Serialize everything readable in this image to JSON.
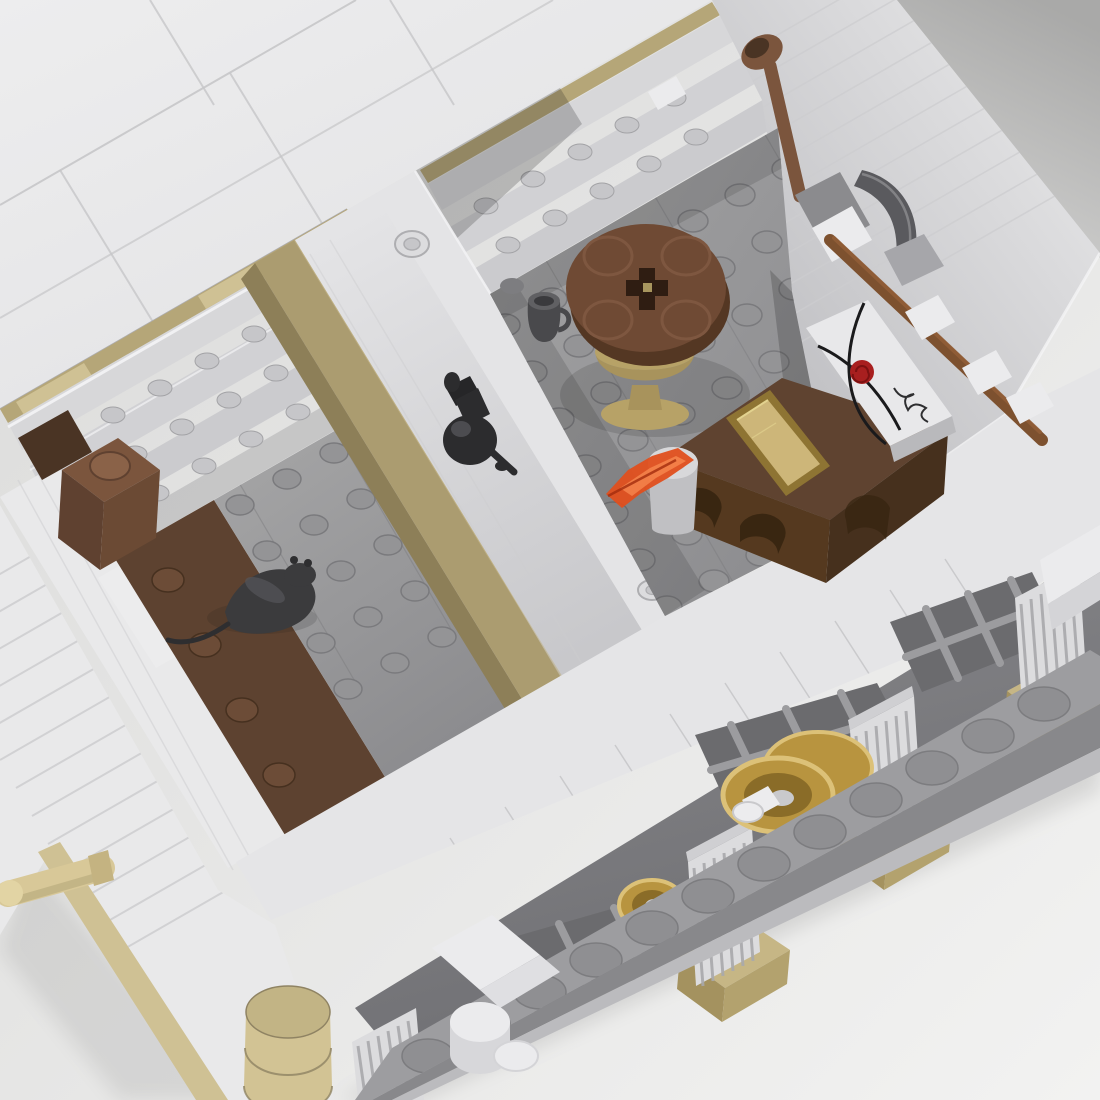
{
  "scene": {
    "description_objects": [
      {
        "id": "roof",
        "label": "white roof tiles"
      },
      {
        "id": "shelves",
        "label": "interior storage shelves with studs"
      },
      {
        "id": "barrel",
        "label": "brown round barrel brick"
      },
      {
        "id": "rat",
        "label": "black rat figure on floor"
      },
      {
        "id": "bench",
        "label": "tan bench along divider wall"
      },
      {
        "id": "divider",
        "label": "white divider wall with hollow studs"
      },
      {
        "id": "lamp",
        "label": "black wall lamp"
      },
      {
        "id": "table",
        "label": "round brown table on gold goblet pedestal"
      },
      {
        "id": "mug",
        "label": "dark gray mug"
      },
      {
        "id": "desk",
        "label": "brown desk with arched front"
      },
      {
        "id": "ingot",
        "label": "gold ingot tile"
      },
      {
        "id": "envelope",
        "label": "white envelope tile with red wax rose and signature"
      },
      {
        "id": "scroll",
        "label": "white paper scroll"
      },
      {
        "id": "flame",
        "label": "translucent orange tool"
      },
      {
        "id": "pickaxe",
        "label": "pickaxe on wall clips"
      },
      {
        "id": "shovel",
        "label": "brown shovel leaning on wall"
      },
      {
        "id": "columns",
        "label": "fluted columns on tan bases"
      },
      {
        "id": "windows",
        "label": "gray lattice windows"
      },
      {
        "id": "wheels",
        "label": "gold coin wheels"
      },
      {
        "id": "platform",
        "label": "studded base platform"
      },
      {
        "id": "corner-column",
        "label": "stacked tan corner column"
      },
      {
        "id": "handrail",
        "label": "tan handrail bar"
      }
    ]
  },
  "palette": {
    "bg_a": "#dadad9",
    "bg_b": "#f2f2f1",
    "corner_a": "#a9a9a8",
    "corner_b": "#d2d2d1",
    "shadow": "#1c1c1c",
    "roof_a": "#ededee",
    "roof_b": "#e2e2e4",
    "roof_seam": "#c7c7c9",
    "wall_light": "#e9e9ea",
    "wall_mid": "#dcdcde",
    "wall_groove": "#cdcdcf",
    "wall_edge": "#aeaeb1",
    "tan": "#b5a678",
    "tan_light": "#cfc194",
    "tan_dark": "#8f8259",
    "board": "#d7d7d9",
    "board2": "#d1d1d4",
    "board3": "#cbcbce",
    "rail": "#f4f4f6",
    "shelf_stud": "#c6c6c9",
    "shelf_stud_line": "#a3a3a6",
    "div_a": "#e4e4e6",
    "div_b": "#c8c8cb",
    "stud_ring": "#dcdcde",
    "stud_ring2": "#c6c6c9",
    "floor_stud": "#949496",
    "floor_stud_line": "#7a7a7d",
    "floor_a": "#a4a4a5",
    "floor_b": "#8a8a8d",
    "brown_floor": "#5d4230",
    "brown_stud": "#6c4c37",
    "brown_stud_line": "#46301f",
    "bench": "#ab9c70",
    "bench_side": "#8d7f58",
    "bench_hi": "#c3b488",
    "barrel_top": "#7b553d",
    "barrel_side": "#5f4130",
    "barrel_side2": "#6b4a34",
    "barrel_stud": "#8a6248",
    "dark_brown": "#4a3424",
    "rat": "#3b3b3d",
    "rat_hi": "#55555a",
    "rat_dark": "#2e2e30",
    "table_top": "#6f4a34",
    "table_rim": "#543723",
    "table_ring": "#7e5740",
    "table_hole": "#2f1d12",
    "gold_fleck": "#a8965e",
    "pedestal": "#b7a267",
    "pedestal_dark": "#a8935c",
    "mug": "#49494c",
    "mug_top": "#606063",
    "mug_inner": "#3a3a3d",
    "gray_piece": "#7d7d80",
    "desk_top": "#5f4330",
    "desk_front": "#55391f",
    "desk_side": "#46301d",
    "desk_arch": "#35230f",
    "ingot_top": "#cdb679",
    "ingot_side": "#8e7433",
    "ingot_edge": "#e2d28f",
    "envelope": "#e8e8ea",
    "envelope_side": "#b9b9bc",
    "cord": "#1a1a1c",
    "rose": "#a81f1f",
    "rose_dark": "#7c1111",
    "scroll": "#d8d8da",
    "scroll_side": "#c0c0c3",
    "flame": "#e04f1d",
    "flame_hi": "#ff9a5e",
    "flame_dark": "#a32c0c",
    "pick_blade": "#5a5a5e",
    "pick_blade_hi": "#86868a",
    "pick_silver": "#a6a6aa",
    "pick_gray": "#8b8b8e",
    "handle": "#7d512f",
    "handle_hi": "#935f38",
    "clip_white": "#ebebed",
    "lamp": "#2c2c2e",
    "lamp_hi": "#4c4c50",
    "lamp_dark": "#262628",
    "face_a": "#ececed",
    "face_b": "#b4b4b8",
    "face_rim": "#f4f4f5",
    "rim": "#e5e5e7",
    "rim_seam": "#c3c3c6",
    "arch_a": "#8a8a8d",
    "arch_b": "#6f6f73",
    "win_dark": "#6b6b6e",
    "win_bar": "#9c9c9f",
    "col_shaft": "#dcdcde",
    "col_cap": "#cfcfd2",
    "col_flute": "#a9a9ac",
    "col_base_top": "#c6b685",
    "col_base_front": "#a4925f",
    "col_base_side": "#b3a26e",
    "plat_top": "#9d9da0",
    "plat_stud": "#8f8f92",
    "plat_stud_line": "#7c7c7f",
    "plat_front": "#88888b",
    "plat_step": "#bbbbbe",
    "gold": "#b8943f",
    "gold_hi": "#dcc178",
    "gold_dark": "#8a6c28",
    "axle": "#ececee",
    "hub": "#c9c9cc",
    "corner_tan_a": "#d2c394",
    "corner_tan_b": "#c2b485",
    "corner_tan_line": "#8f8363",
    "handle_tan": "#d8c898",
    "handle_tan_dark": "#b5a97a",
    "handle_tan_cap": "#e2d4a4",
    "collar": "#c4b381",
    "white_tile": "#ececed",
    "bracket2": "#dfdfe2",
    "bracket3": "#d7d7da",
    "ledge_side": "#d4d4d7"
  },
  "stud_grids": [
    {
      "target": "#g-left-floor-studs",
      "origin": [
        240,
        505
      ],
      "a": [
        47,
        -26
      ],
      "na": 5,
      "b": [
        27,
        46
      ],
      "nb": 5,
      "rx": 14,
      "ry": 10,
      "fill": "floor_stud",
      "stroke": "floor_stud_line",
      "sw": 1.5
    },
    {
      "target": "#g-brown-studs",
      "origin": [
        168,
        580
      ],
      "a": [
        1,
        0
      ],
      "na": 1,
      "b": [
        37,
        65
      ],
      "nb": 4,
      "rx": 16,
      "ry": 12,
      "fill": "brown_stud",
      "stroke": "brown_stud_line",
      "sw": 1.5
    },
    {
      "target": "#g-right-floor-studs",
      "origin": [
        505,
        325
      ],
      "a": [
        47,
        -26
      ],
      "na": 8,
      "b": [
        27,
        47
      ],
      "nb": 7,
      "rx": 15,
      "ry": 11,
      "fill": "floor_stud",
      "stroke": "floor_stud_line",
      "sw": 1.5
    },
    {
      "target": "#g-platform-studs",
      "origin": [
        428,
        1056
      ],
      "a": [
        56,
        -32
      ],
      "na": 12,
      "b": [
        30,
        52
      ],
      "nb": 2,
      "rx": 26,
      "ry": 17,
      "fill": "plat_stud",
      "stroke": "plat_stud_line",
      "sw": 1.5
    },
    {
      "target": "#g-shelfL-studs",
      "origin": [
        66,
        442
      ],
      "a": [
        47,
        -27
      ],
      "na": 6,
      "b": [
        22,
        39
      ],
      "nb": 3,
      "rx": 12,
      "ry": 8,
      "fill": "shelf_stud",
      "stroke": "shelf_stud_line",
      "sw": 1
    },
    {
      "target": "#g-shelfR-studs",
      "origin": [
        486,
        206
      ],
      "a": [
        47,
        -27
      ],
      "na": 5,
      "b": [
        22,
        39
      ],
      "nb": 3,
      "rx": 12,
      "ry": 8,
      "fill": "shelf_stud",
      "stroke": "shelf_stud_line",
      "sw": 1
    }
  ],
  "line_sets": [
    {
      "target": "#g-roof-seams",
      "origin": [
        0,
        205
      ],
      "step": [
        0,
        0
      ],
      "n": 1,
      "dir": [
        356,
        -205
      ],
      "stroke": "roof_seam",
      "w": 2,
      "op": 0.9
    },
    {
      "target": "#g-roof-seams",
      "origin": [
        0,
        318
      ],
      "step": [
        0,
        0
      ],
      "n": 1,
      "dir": [
        553,
        -318
      ],
      "stroke": "roof_seam",
      "w": 2,
      "op": 0.7
    },
    {
      "target": "#g-roof-seams",
      "origin": [
        150,
        0
      ],
      "step": [
        240,
        0
      ],
      "n": 2,
      "dir": [
        64,
        105
      ],
      "stroke": "roof_seam",
      "w": 2,
      "op": 0.8
    },
    {
      "target": "#g-roof-seams",
      "origin": [
        60,
        170
      ],
      "step": [
        170,
        -97
      ],
      "n": 2,
      "dir": [
        93,
        152
      ],
      "stroke": "roof_seam",
      "w": 2,
      "op": 0.8
    },
    {
      "target": "#g-face-grooves",
      "origin": [
        560,
        160
      ],
      "step": [
        14,
        24
      ],
      "n": 11,
      "dir": [
        560,
        -322
      ],
      "stroke": "wall_groove",
      "w": 1.6,
      "op": 0.75
    },
    {
      "target": "#g-sw-grooves",
      "origin": [
        -80,
        620
      ],
      "step": [
        16,
        28
      ],
      "n": 13,
      "dir": [
        520,
        -299
      ],
      "stroke": "wall_groove",
      "w": 2,
      "op": 0.85
    },
    {
      "target": "#g-westband-grooves",
      "origin": [
        18,
        480
      ],
      "step": [
        18,
        -10
      ],
      "n": 2,
      "dir": [
        215,
        390
      ],
      "stroke": "wall_groove",
      "w": 1.5,
      "op": 0.5
    },
    {
      "target": "#g-div-grooves",
      "origin": [
        330,
        240
      ],
      "step": [
        -20,
        14
      ],
      "n": 2,
      "dir": [
        252,
        424
      ],
      "stroke": "wall_groove",
      "w": 1.5,
      "op": 0.45
    },
    {
      "target": "#g-rim-seams",
      "origin": [
        340,
        900
      ],
      "step": [
        55,
        -31
      ],
      "n": 12,
      "dir": [
        40,
        62
      ],
      "stroke": "rim_seam",
      "w": 1.5,
      "op": 0.8
    },
    {
      "target": "#g-platform-seams",
      "origin": [
        480,
        1090
      ],
      "step": [
        110,
        -63
      ],
      "n": 7,
      "dir": [
        34,
        58
      ],
      "stroke": "plat_stud_line",
      "w": 1.5,
      "op": 0.7
    },
    {
      "target": "#g-leftfloor-seams",
      "origin": [
        150,
        330
      ],
      "step": [
        95,
        -54
      ],
      "n": 3,
      "dir": [
        210,
        360
      ],
      "stroke": "floor_stud_line",
      "w": 1.2,
      "op": 0.45
    },
    {
      "target": "#g-rightfloor-seams",
      "origin": [
        540,
        250
      ],
      "step": [
        110,
        -62
      ],
      "n": 3,
      "dir": [
        215,
        370
      ],
      "stroke": "floor_stud_line",
      "w": 1.2,
      "op": 0.45
    },
    {
      "target": "#g-flutes-c1",
      "origin": [
        358,
        1046
      ],
      "step": [
        10,
        -5
      ],
      "n": 6,
      "dir": [
        8,
        56
      ],
      "stroke": "col_flute",
      "w": 3,
      "op": 0.9
    },
    {
      "target": "#g-flutes-c2",
      "origin": [
        694,
        868
      ],
      "step": [
        10,
        -5
      ],
      "n": 6,
      "dir": [
        9,
        118
      ],
      "stroke": "col_flute",
      "w": 3,
      "op": 0.9
    },
    {
      "target": "#g-flutes-c3",
      "origin": [
        856,
        736
      ],
      "step": [
        10,
        -5
      ],
      "n": 6,
      "dir": [
        9,
        118
      ],
      "stroke": "col_flute",
      "w": 3,
      "op": 0.9
    },
    {
      "target": "#g-flutes-c4",
      "origin": [
        1021,
        604
      ],
      "step": [
        10,
        -5
      ],
      "n": 6,
      "dir": [
        9,
        118
      ],
      "stroke": "col_flute",
      "w": 3,
      "op": 0.9
    }
  ]
}
